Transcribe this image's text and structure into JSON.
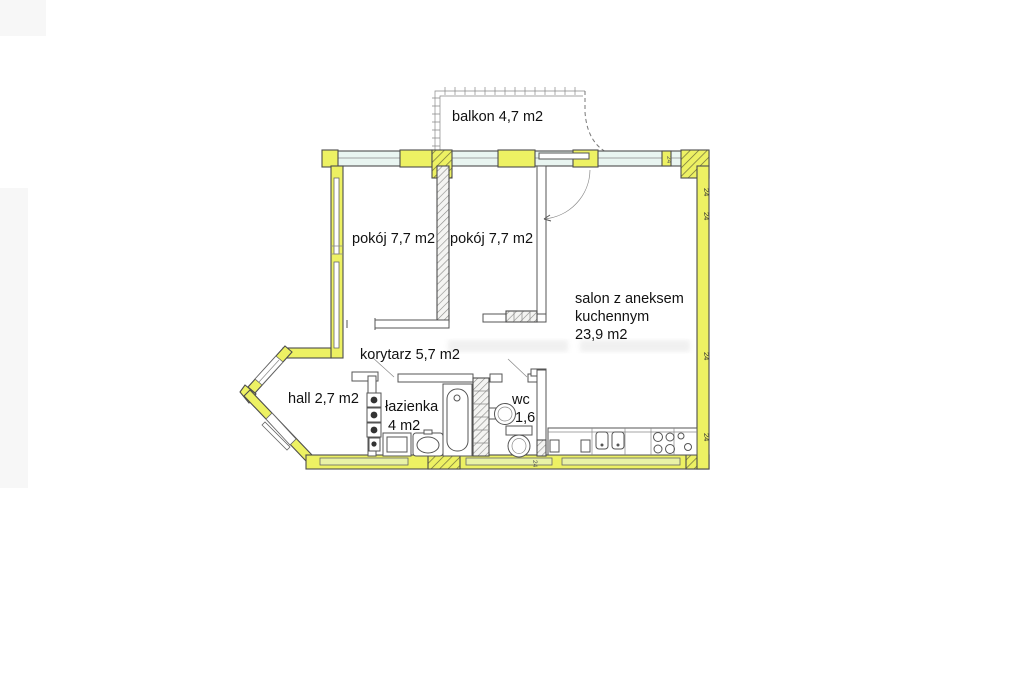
{
  "floor_plan": {
    "type": "apartment-floor-plan",
    "language": "pl",
    "rooms": [
      {
        "name": "balkon",
        "area": "4,7 m2",
        "label": "balkon 4,7 m2"
      },
      {
        "name": "pokój",
        "area": "7,7 m2",
        "label": "pokój 7,7 m2"
      },
      {
        "name": "pokój",
        "area": "7,7 m2",
        "label": "pokój 7,7 m2"
      },
      {
        "name": "salon z aneksem kuchennym",
        "area": "23,9 m2",
        "label_lines": [
          "salon z aneksem",
          "kuchennym",
          "23,9 m2"
        ]
      },
      {
        "name": "korytarz",
        "area": "5,7 m2",
        "label": "korytarz 5,7 m2"
      },
      {
        "name": "hall",
        "area": "2,7 m2",
        "label": "hall 2,7 m2"
      },
      {
        "name": "łazienka",
        "area": "4 m2",
        "label_lines": [
          "łazienka",
          "4 m2"
        ]
      },
      {
        "name": "wc",
        "area": "1,6",
        "label_lines": [
          "wc",
          "1,6"
        ]
      }
    ],
    "annotations": {
      "wall_thickness": "24"
    },
    "colors": {
      "wall_yellow": "#edf163",
      "window_glass": "#e9f5f1",
      "window_sill": "#e9f2a6",
      "outline": "#4d4d4d"
    }
  }
}
